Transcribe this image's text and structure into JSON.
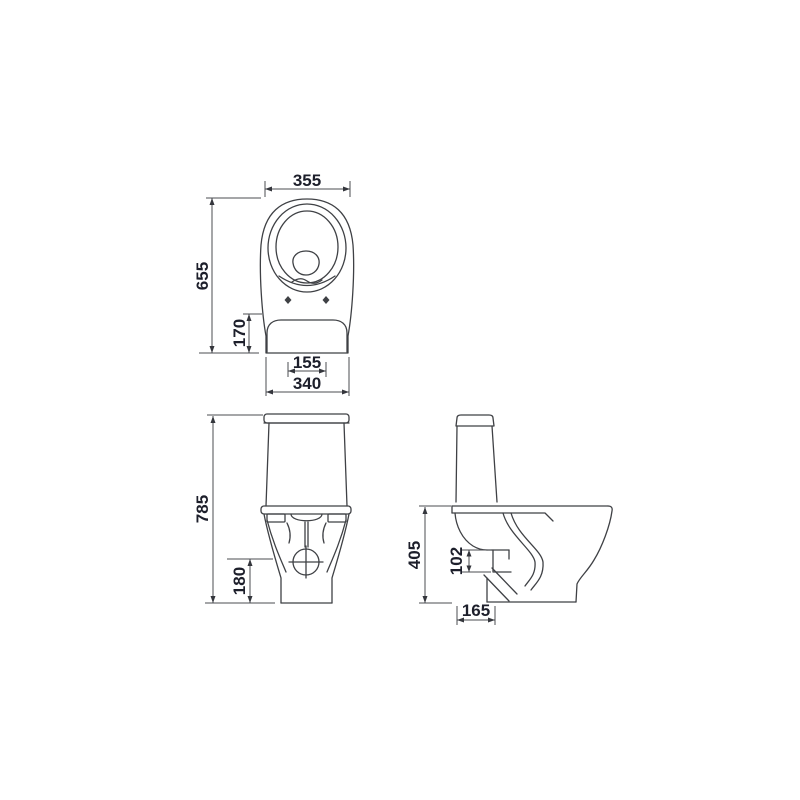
{
  "style": {
    "background": "#ffffff",
    "line_color": "#3f4145",
    "dim_line_color": "#4b4d52",
    "dim_text_color": "#1d1f2b"
  },
  "dimensions": {
    "top_view": {
      "seat_width": "355",
      "total_depth": "655",
      "tank_depth": "170",
      "seat_hole_spacing": "155",
      "tank_width": "340"
    },
    "front_view": {
      "total_height": "785",
      "drain_center_height": "180"
    },
    "side_view": {
      "bowl_height": "405",
      "outlet_height": "102",
      "outlet_offset": "165"
    }
  }
}
